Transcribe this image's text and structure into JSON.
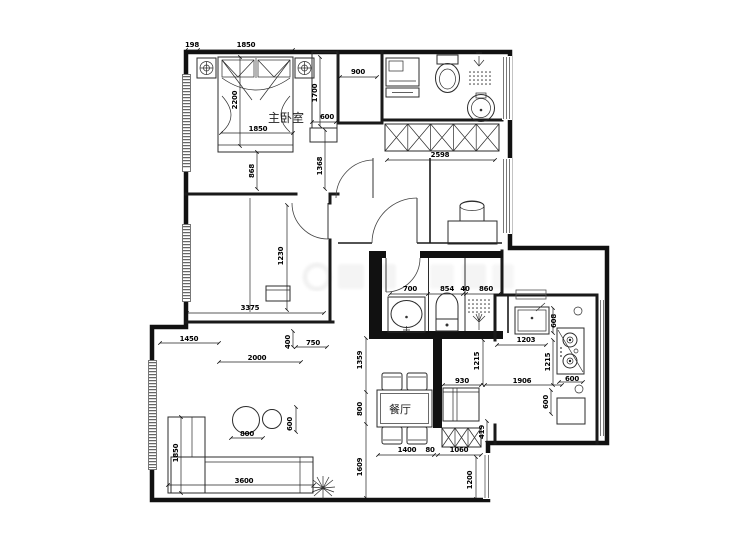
{
  "rooms": {
    "master": "主卧室",
    "dining": "餐厅"
  },
  "dims": [
    {
      "n": "dim-198",
      "v": "198"
    },
    {
      "n": "dim-1850-top",
      "v": "1850"
    },
    {
      "n": "dim-2200",
      "v": "2200"
    },
    {
      "n": "dim-1850-bed",
      "v": "1850"
    },
    {
      "n": "dim-868",
      "v": "868"
    },
    {
      "n": "dim-900",
      "v": "900"
    },
    {
      "n": "dim-1700",
      "v": "1700"
    },
    {
      "n": "dim-600-niche",
      "v": "600"
    },
    {
      "n": "dim-1368",
      "v": "1368"
    },
    {
      "n": "dim-2598",
      "v": "2598"
    },
    {
      "n": "dim-700",
      "v": "700"
    },
    {
      "n": "dim-854",
      "v": "854"
    },
    {
      "n": "dim-40",
      "v": "40"
    },
    {
      "n": "dim-860",
      "v": "860"
    },
    {
      "n": "dim-1230",
      "v": "1230"
    },
    {
      "n": "dim-3375",
      "v": "3375"
    },
    {
      "n": "dim-1450",
      "v": "1450"
    },
    {
      "n": "dim-400",
      "v": "400"
    },
    {
      "n": "dim-750",
      "v": "750"
    },
    {
      "n": "dim-2000",
      "v": "2000"
    },
    {
      "n": "dim-800-table",
      "v": "800"
    },
    {
      "n": "dim-600-table",
      "v": "600"
    },
    {
      "n": "dim-1850-sofa",
      "v": "1850"
    },
    {
      "n": "dim-3600",
      "v": "3600"
    },
    {
      "n": "dim-1359",
      "v": "1359"
    },
    {
      "n": "dim-800-dining",
      "v": "800"
    },
    {
      "n": "dim-1609",
      "v": "1609"
    },
    {
      "n": "dim-1400",
      "v": "1400"
    },
    {
      "n": "dim-80",
      "v": "80"
    },
    {
      "n": "dim-1060",
      "v": "1060"
    },
    {
      "n": "dim-1200",
      "v": "1200"
    },
    {
      "n": "dim-419",
      "v": "419"
    },
    {
      "n": "dim-930",
      "v": "930"
    },
    {
      "n": "dim-1215-hall",
      "v": "1215"
    },
    {
      "n": "dim-1906",
      "v": "1906"
    },
    {
      "n": "dim-1203",
      "v": "1203"
    },
    {
      "n": "dim-608",
      "v": "608"
    },
    {
      "n": "dim-1215-kitchen",
      "v": "1215"
    },
    {
      "n": "dim-600-stove",
      "v": "600"
    },
    {
      "n": "dim-600-kitchen",
      "v": "600"
    }
  ]
}
